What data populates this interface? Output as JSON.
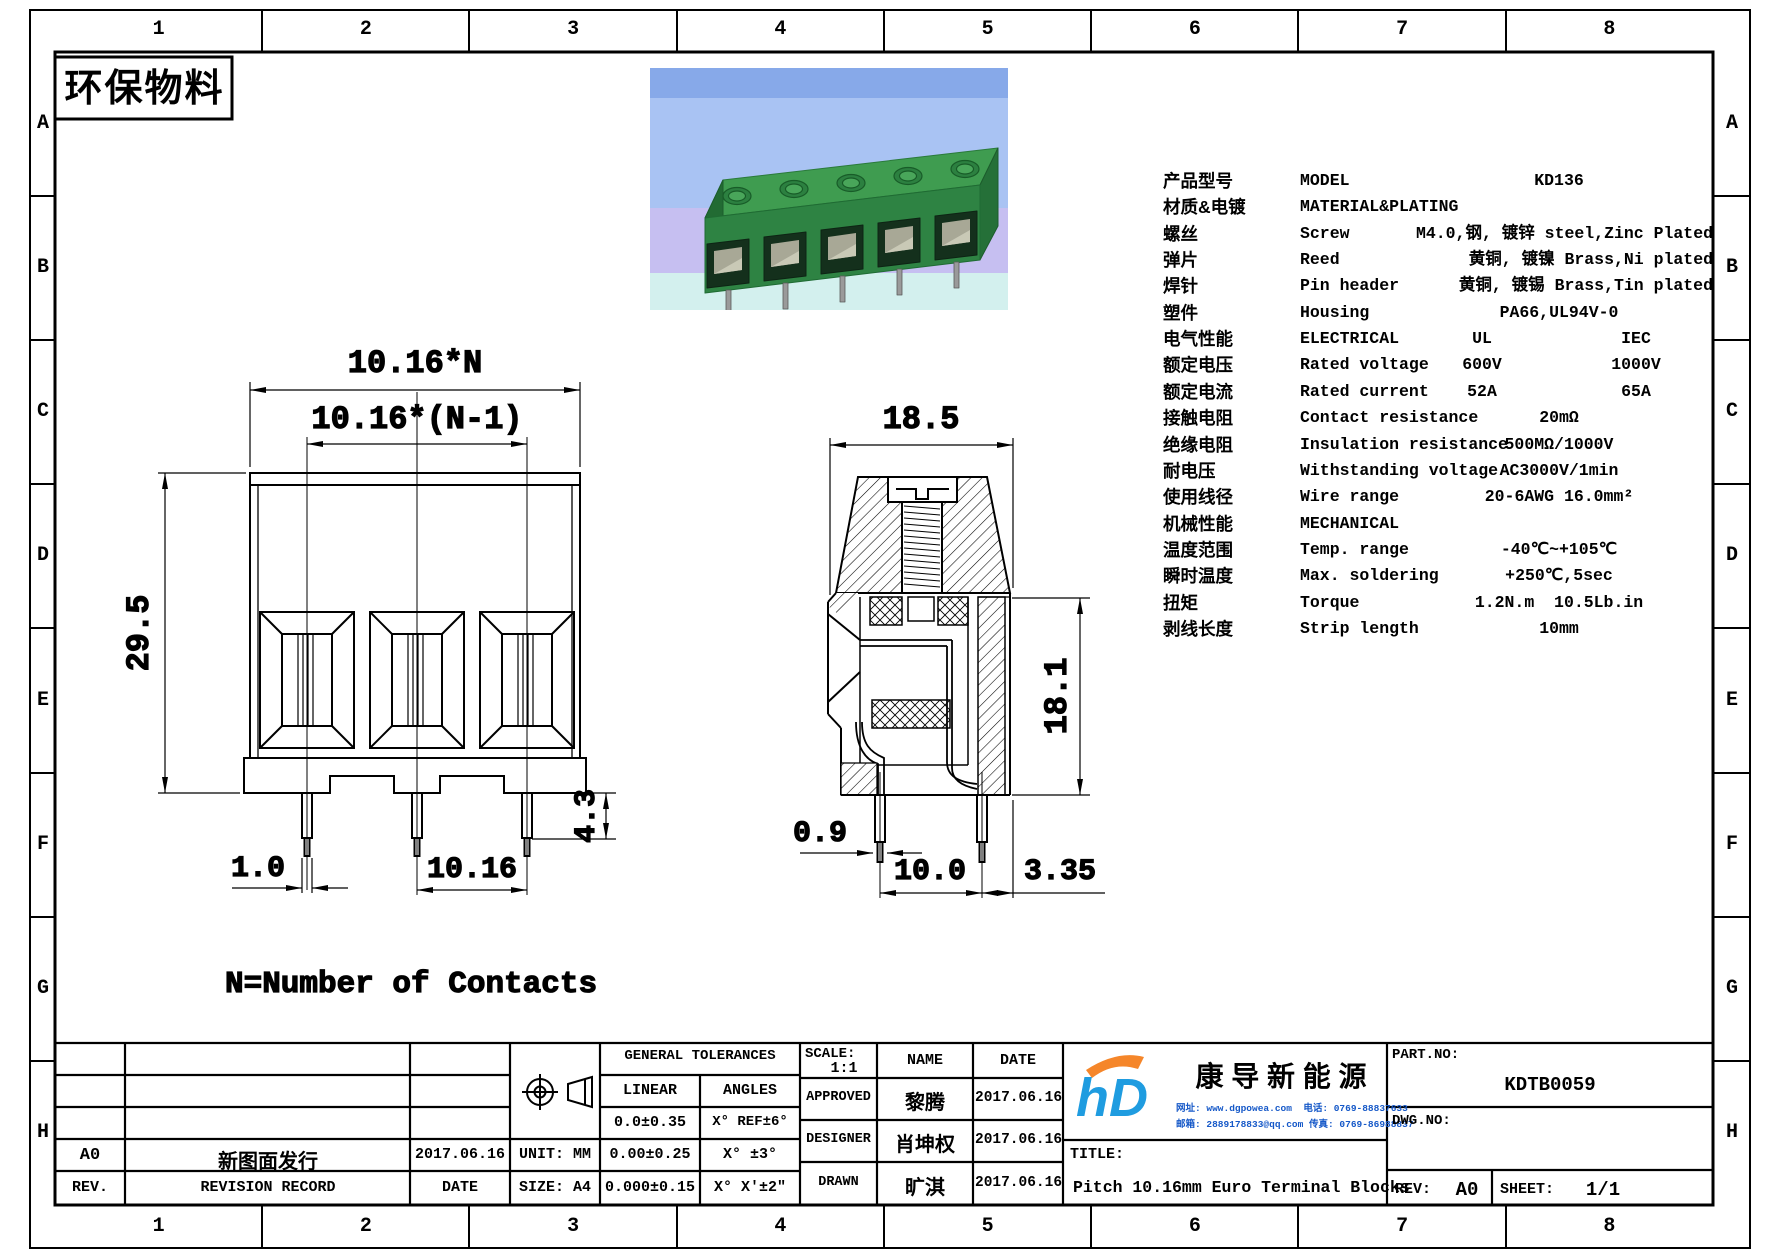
{
  "sheet": {
    "zone_numbers": [
      "1",
      "2",
      "3",
      "4",
      "5",
      "6",
      "7",
      "8"
    ],
    "zone_letters": [
      "A",
      "B",
      "C",
      "D",
      "E",
      "F",
      "G",
      "H"
    ],
    "eco_stamp": "环保物料"
  },
  "drawing": {
    "front_view": {
      "dim_total_width": "10.16*N",
      "dim_pitch_width": "10.16*(N-1)",
      "dim_height": "29.5",
      "dim_pin_width": "1.0",
      "dim_pin_pitch": "10.16",
      "dim_pin_length": "4.3",
      "note": "N=Number of Contacts"
    },
    "side_view": {
      "dim_width": "18.5",
      "dim_height": "18.1",
      "dim_pin_width": "0.9",
      "dim_pin_spacing": "10.0",
      "dim_pin_offset": "3.35"
    }
  },
  "spec_table": {
    "rows": [
      {
        "cn": "产品型号",
        "en": "MODEL",
        "val": "KD136"
      },
      {
        "cn": "材质&电镀",
        "en": "MATERIAL&PLATING",
        "val": ""
      },
      {
        "cn": "螺丝",
        "en": "Screw",
        "val": "M4.0,钢, 镀锌 steel,Zinc Plated"
      },
      {
        "cn": "弹片",
        "en": "Reed",
        "val": "黄铜, 镀镍 Brass,Ni plated"
      },
      {
        "cn": "焊针",
        "en": "Pin header",
        "val": "黄铜, 镀锡 Brass,Tin plated"
      },
      {
        "cn": "塑件",
        "en": "Housing",
        "val": "PA66,UL94V-0"
      },
      {
        "cn": "电气性能",
        "en": "ELECTRICAL",
        "val": "UL",
        "val2": "IEC"
      },
      {
        "cn": "额定电压",
        "en": "Rated voltage",
        "val": "600V",
        "val2": "1000V"
      },
      {
        "cn": "额定电流",
        "en": "Rated current",
        "val": "52A",
        "val2": "65A"
      },
      {
        "cn": "接触电阻",
        "en": "Contact resistance",
        "val": "20mΩ"
      },
      {
        "cn": "绝缘电阻",
        "en": "Insulation resistance",
        "val": "500MΩ/1000V"
      },
      {
        "cn": "耐电压",
        "en": "Withstanding voltage",
        "val": "AC3000V/1min"
      },
      {
        "cn": "使用线径",
        "en": "Wire range",
        "val": "20-6AWG 16.0mm²"
      },
      {
        "cn": "机械性能",
        "en": "MECHANICAL",
        "val": ""
      },
      {
        "cn": "温度范围",
        "en": "Temp. range",
        "val": "-40℃~+105℃"
      },
      {
        "cn": "瞬时温度",
        "en": "Max. soldering",
        "val": "+250℃,5sec"
      },
      {
        "cn": "扭矩",
        "en": "Torque",
        "val": "1.2N.m  10.5Lb.in"
      },
      {
        "cn": "剥线长度",
        "en": "Strip length",
        "val": "10mm"
      }
    ]
  },
  "title_block": {
    "general_tolerances": {
      "header": "GENERAL TOLERANCES",
      "linear": "LINEAR",
      "angles": "ANGLES",
      "rows": [
        [
          "0.0±0.35",
          "X° REF±6°"
        ],
        [
          "0.00±0.25",
          "X° ±3°"
        ],
        [
          "0.000±0.15",
          "X° X'±2\""
        ]
      ]
    },
    "unit": "UNIT: MM",
    "size": "SIZE: A4",
    "revision": {
      "rev": "A0",
      "desc": "新图面发行",
      "date": "2017.06.16",
      "rev_header": "REV.",
      "desc_header": "REVISION RECORD",
      "date_header": "DATE"
    },
    "scale_label": "SCALE:",
    "scale_value": "1:1",
    "name_header": "NAME",
    "date_header": "DATE",
    "signoff": [
      {
        "role": "APPROVED",
        "name": "黎腾",
        "date": "2017.06.16"
      },
      {
        "role": "DESIGNER",
        "name": "肖坤权",
        "date": "2017.06.16"
      },
      {
        "role": "DRAWN",
        "name": "旷淇",
        "date": "2017.06.16"
      }
    ],
    "company": {
      "name": "康 导 新 能 源",
      "contact1": "网址: www.dgpowea.com  电话: 0769-88837633",
      "contact2": "邮箱: 2889178833@qq.com 传真: 0769-86988837"
    },
    "title_label": "TITLE:",
    "title_value": "Pitch 10.16mm Euro Terminal Blocks",
    "part_no_label": "PART.NO:",
    "part_no": "KDTB0059",
    "dwg_no_label": "DWG.NO:",
    "rev_label": "REV:",
    "rev": "A0",
    "sheet_label": "SHEET:",
    "sheet": "1/1"
  }
}
